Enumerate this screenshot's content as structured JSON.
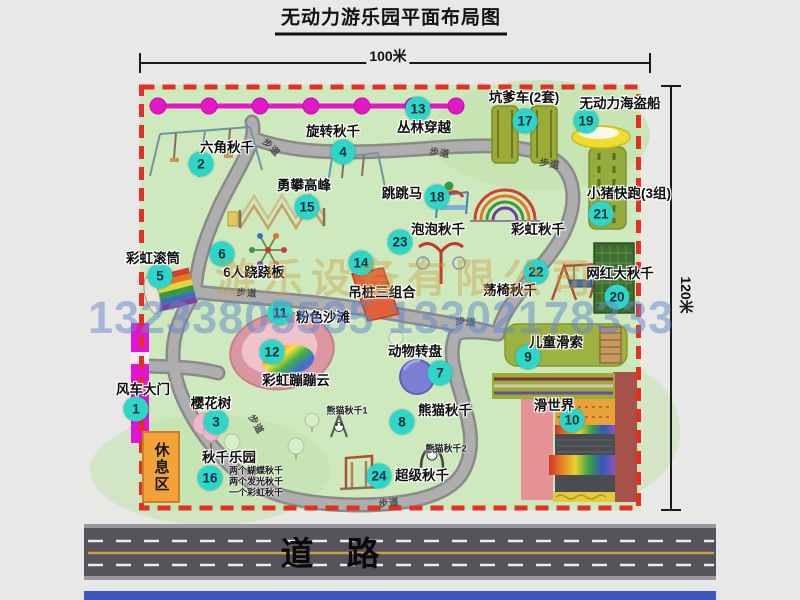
{
  "title": "无动力游乐园平面布局图",
  "dimensions": {
    "width": "100米",
    "height": "120米"
  },
  "road_label": "道　路",
  "rest_area": "休息区",
  "walkway_label": "步道",
  "watermark": {
    "line1": "游乐设备有限公司",
    "line2": "13233805535 13302178333"
  },
  "colors": {
    "map_green": "#cde9bd",
    "border_red": "#e33022",
    "badge_cyan": "#2ed5c9",
    "zipline_magenta": "#e318c7",
    "gate_magenta": "#e013d6",
    "rest_orange": "#f3a13b",
    "road_grey": "#56535d"
  },
  "items": [
    {
      "num": "1",
      "label": "风车大门",
      "bx": 136,
      "by": 409,
      "lx": 143,
      "ly": 388
    },
    {
      "num": "2",
      "label": "六角秋千",
      "bx": 201,
      "by": 164,
      "lx": 227,
      "ly": 146
    },
    {
      "num": "3",
      "label": "樱花树",
      "bx": 216,
      "by": 422,
      "lx": 211,
      "ly": 402
    },
    {
      "num": "4",
      "label": "旋转秋千",
      "bx": 343,
      "by": 152,
      "lx": 333,
      "ly": 130
    },
    {
      "num": "5",
      "label": "彩虹滚筒",
      "bx": 160,
      "by": 276,
      "lx": 153,
      "ly": 257
    },
    {
      "num": "6",
      "label": "6人跷跷板",
      "bx": 222,
      "by": 254,
      "lx": 254,
      "ly": 271
    },
    {
      "num": "7",
      "label": "动物转盘",
      "bx": 440,
      "by": 373,
      "lx": 415,
      "ly": 350
    },
    {
      "num": "8",
      "label": "熊猫秋千",
      "bx": 402,
      "by": 422,
      "lx": 445,
      "ly": 409
    },
    {
      "num": "9",
      "label": "儿童滑索",
      "bx": 528,
      "by": 357,
      "lx": 556,
      "ly": 341
    },
    {
      "num": "10",
      "label": "滑世界",
      "bx": 572,
      "by": 420,
      "lx": 554,
      "ly": 404
    },
    {
      "num": "11",
      "label": "粉色沙滩",
      "bx": 280,
      "by": 313,
      "lx": 323,
      "ly": 316
    },
    {
      "num": "12",
      "label": "彩虹蹦蹦云",
      "bx": 272,
      "by": 352,
      "lx": 296,
      "ly": 379
    },
    {
      "num": "13",
      "label": "丛林穿越",
      "bx": 418,
      "by": 109,
      "lx": 424,
      "ly": 126
    },
    {
      "num": "14",
      "label": "吊桩三组合",
      "bx": 361,
      "by": 263,
      "lx": 382,
      "ly": 291
    },
    {
      "num": "15",
      "label": "勇攀高峰",
      "bx": 307,
      "by": 207,
      "lx": 304,
      "ly": 184
    },
    {
      "num": "16",
      "label": "秋千乐园",
      "bx": 210,
      "by": 478,
      "lx": 229,
      "ly": 456
    },
    {
      "num": "17",
      "label": "坑爹车(2套)",
      "bx": 525,
      "by": 121,
      "lx": 524,
      "ly": 96
    },
    {
      "num": "18",
      "label": "跳跳马",
      "bx": 437,
      "by": 197,
      "lx": 402,
      "ly": 192
    },
    {
      "num": "19",
      "label": "无动力海盗船",
      "bx": 586,
      "by": 121,
      "lx": 620,
      "ly": 102
    },
    {
      "num": "20",
      "label": "网红大秋千",
      "bx": 617,
      "by": 297,
      "lx": 620,
      "ly": 272
    },
    {
      "num": "21",
      "label": "小猪快跑(3组)",
      "bx": 601,
      "by": 214,
      "lx": 629,
      "ly": 192
    },
    {
      "num": "22",
      "label": "荡椅秋千",
      "bx": 536,
      "by": 272,
      "lx": 510,
      "ly": 289
    },
    {
      "num": "23",
      "label": "泡泡秋千",
      "bx": 400,
      "by": 242,
      "lx": 438,
      "ly": 228
    },
    {
      "num": "24",
      "label": "超级秋千",
      "bx": 379,
      "by": 476,
      "lx": 422,
      "ly": 474
    }
  ],
  "plain_labels": [
    {
      "text": "彩虹秋千",
      "x": 538,
      "y": 228
    }
  ],
  "notes": [
    {
      "text": "熊猫秋千1",
      "x": 347,
      "y": 410
    },
    {
      "text": "熊猫秋千2",
      "x": 446,
      "y": 448
    },
    {
      "text": "两个蝴蝶秋千",
      "x": 256,
      "y": 470
    },
    {
      "text": "两个发光秋千",
      "x": 256,
      "y": 481
    },
    {
      "text": "一个彩虹秋千",
      "x": 256,
      "y": 492
    }
  ],
  "walkways": [
    {
      "x": 272,
      "y": 147,
      "rot": 45
    },
    {
      "x": 440,
      "y": 152,
      "rot": 8
    },
    {
      "x": 550,
      "y": 163,
      "rot": 10
    },
    {
      "x": 247,
      "y": 292,
      "rot": 4
    },
    {
      "x": 466,
      "y": 321,
      "rot": 4
    },
    {
      "x": 257,
      "y": 424,
      "rot": 60
    },
    {
      "x": 389,
      "y": 502,
      "rot": -6
    }
  ]
}
